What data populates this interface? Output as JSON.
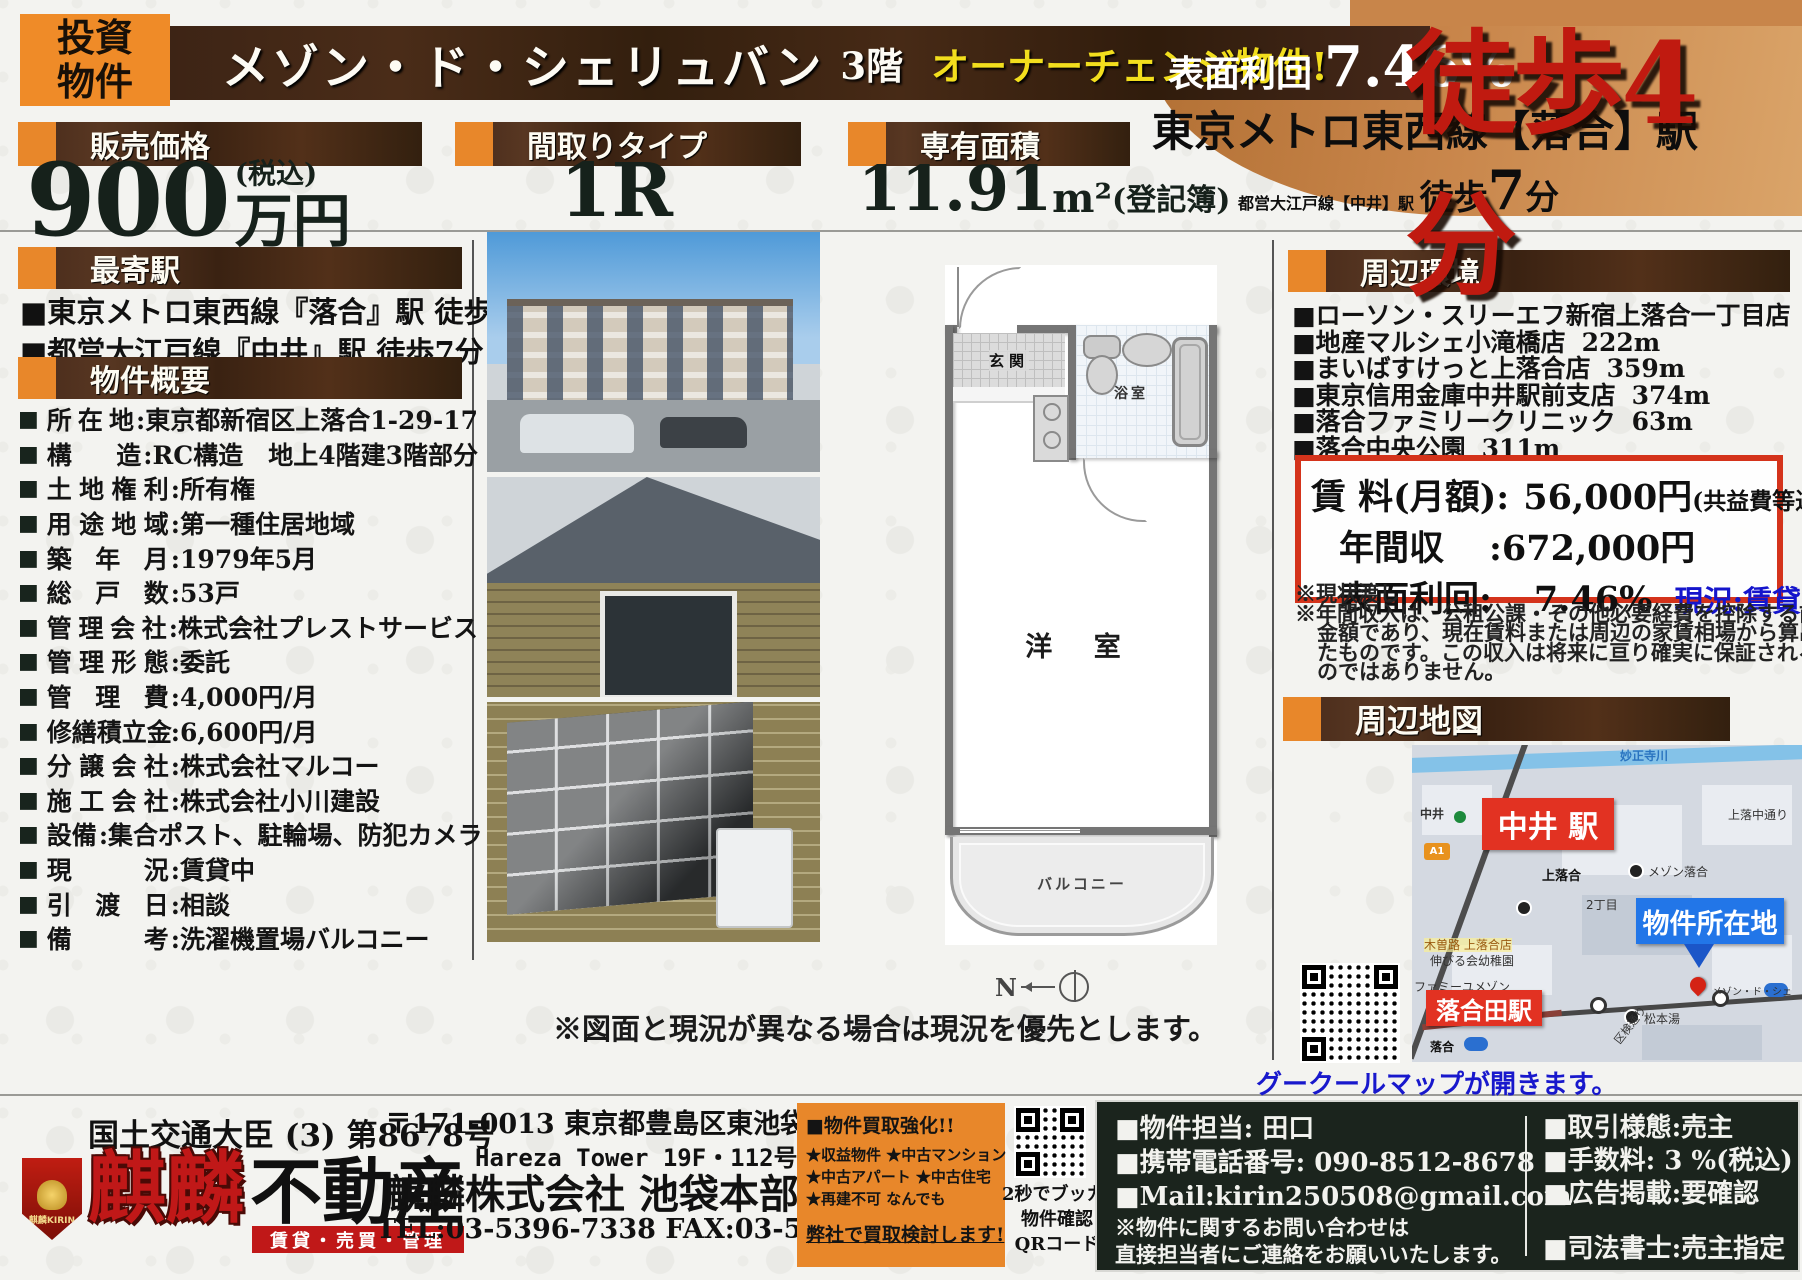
{
  "badge": {
    "line1": "投資",
    "line2": "物件"
  },
  "title": {
    "name": "メゾン・ド・シェリュバン",
    "floor": "3階",
    "highlight": "オーナーチェンジ物件!"
  },
  "yield_banner": {
    "label": "表面利回",
    "value": "7.46%"
  },
  "access": {
    "station1": "東京メトロ東西線【落合】駅",
    "walk1": "徒歩4分",
    "station2": "都営大江戸線【中井】駅",
    "walk2_pre": "徒歩",
    "walk2_num": "7",
    "walk2_suf": "分"
  },
  "price": {
    "label": "販売価格",
    "value": "900",
    "unit": "万円",
    "tax": "(税込)"
  },
  "layout": {
    "label": "間取りタイプ",
    "value": "1R"
  },
  "area": {
    "label": "専有面積",
    "value": "11.91",
    "unit": "m²",
    "note": "(登記簿)"
  },
  "nearest": {
    "title": "最寄駅",
    "items": [
      "■東京メトロ東西線『落合』駅 徒歩4分",
      "■都営大江戸線『中井』駅 徒歩7分"
    ]
  },
  "overview": {
    "title": "物件概要",
    "rows": [
      {
        "l": "所在地",
        "v": ":東京都新宿区上落合1-29-17"
      },
      {
        "l": "構造",
        "v": ":RC構造　地上4階建3階部分"
      },
      {
        "l": "土地権利",
        "v": ":所有権"
      },
      {
        "l": "用途地域",
        "v": ":第一種住居地域"
      },
      {
        "l": "築年月",
        "v": ":1979年5月"
      },
      {
        "l": "総戸数",
        "v": ":53戸"
      },
      {
        "l": "管理会社",
        "v": ":株式会社プレストサービス"
      },
      {
        "l": "管理形態",
        "v": ":委託"
      },
      {
        "l": "管理費",
        "v": ":4,000円/月"
      },
      {
        "l": "修繕積立金",
        "v": ":6,600円/月"
      },
      {
        "l": "分譲会社",
        "v": ":株式会社マルコー"
      },
      {
        "l": "施工会社",
        "v": ":株式会社小川建設"
      },
      {
        "l": "設備",
        "v": ":集合ポスト、駐輪場、防犯カメラ"
      },
      {
        "l": "現況",
        "v": ":賃貸中"
      },
      {
        "l": "引渡日",
        "v": ":相談"
      },
      {
        "l": "備考",
        "v": ":洗濯機置場バルコニー"
      }
    ]
  },
  "floorplan": {
    "genkan": "玄関",
    "bath": "浴室",
    "room": "洋 室",
    "balcony": "バルコニー",
    "compass": "N"
  },
  "plan_note": "※図面と現況が異なる場合は現況を優先とします。",
  "surroundings": {
    "title": "周辺環境",
    "items": [
      {
        "n": "■ローソン・スリーエフ新宿上落合一丁目店",
        "d": "47m"
      },
      {
        "n": "■地産マルシェ小滝橋店",
        "d": "222m"
      },
      {
        "n": "■まいばすけっと上落合店",
        "d": "359m"
      },
      {
        "n": "■東京信用金庫中井駅前支店",
        "d": "374m"
      },
      {
        "n": "■落合ファミリークリニック",
        "d": "63m"
      },
      {
        "n": "■落合中央公園",
        "d": "311m"
      }
    ]
  },
  "income": {
    "line1_label": "賃 料(月額):",
    "line1_value": "56,000円",
    "line1_note": "(共益費等込み)",
    "line2_label": "年間収",
    "line2_value": ":672,000円",
    "line3_label": "表面利回:",
    "line3_value": "7.46%",
    "status": "現況:賃貸中"
  },
  "income_notes": [
    "※現状渡し",
    "※年間収入は、公租公課・その他必要経費を控除する前の",
    "金額であり、現在賃料または周辺の家賃相場から算出し",
    "たものです。この収入は将来に亘り確実に保証されるも",
    "のではありません。"
  ],
  "map": {
    "title": "周辺地図",
    "river": "妙正寺川",
    "nakai_station": "中井 駅",
    "nakai_small": "中井",
    "a1": "A1",
    "kamiochi_dori": "上落中通り",
    "mezon_ochiai": "メゾン落合",
    "kamiochiai": "上落合",
    "chome": "2丁目",
    "property": "物件所在地",
    "pin_note": "メゾン・ド・シェ",
    "kisoji": "木曽路 上落合店",
    "kindergarten": "伸びる会幼稚園",
    "famiyu": "ファミーユメゾン",
    "ochiai_station": "落合田駅",
    "matsumoto": "松本湯",
    "kuken": "区検通り",
    "ochiai_small": "落合",
    "qr_caption": "グークールマップが開きます。"
  },
  "footer": {
    "license": "国土交通大臣 (3) 第8678号",
    "logo_badge": "麒麟KIRIN",
    "logo_main": "麒麟",
    "logo_sub": "不動産",
    "logo_banner": "賃貸・売買・管理",
    "addr1": "〒171-0013 東京都豊島区東池袋1-18-1",
    "addr2": "Hareza Tower 19F・112号室",
    "company": "麒麟株式会社 池袋本部",
    "telfax": "TEL:03-5396-7338 FAX:03-5396-7339",
    "buy_title": "■物件買取強化!!",
    "buy_lines": [
      "★収益物件 ★中古マンション",
      "★中古アパート ★中古住宅",
      "★再建不可 なんでも"
    ],
    "buy_cta": "弊社で買取検討します!",
    "qr_caption": [
      "2秒でブッカク",
      "物件確認",
      "QRコード"
    ],
    "contact_lines": [
      "■物件担当: 田口",
      "■携帯電話番号: 090-8512-8678",
      "■Mail:kirin250508@gmail.com",
      "※物件に関するお問い合わせは",
      "直接担当者にご連絡をお願いいたします。"
    ],
    "terms_lines": [
      "■取引様態:売主",
      "■手数料: 3 %(税込)",
      "■広告掲載:要確認",
      "■司法書士:売主指定"
    ]
  },
  "colors": {
    "accent_orange": "#e8872a",
    "dark_brown": "#3a2317",
    "tan": "#c8854a",
    "red": "#c01a10",
    "blue": "#1515cc",
    "footer_dark": "#1b241d"
  }
}
